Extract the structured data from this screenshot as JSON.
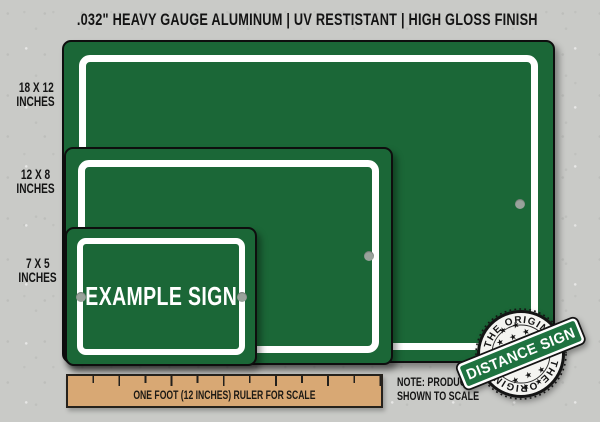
{
  "header": {
    "title": ".032\" HEAVY GAUGE ALUMINUM | UV RESTISTANT | HIGH GLOSS FINISH"
  },
  "size_labels": [
    {
      "size": "18 X 12",
      "unit": "INCHES"
    },
    {
      "size": "12 X 8",
      "unit": "INCHES"
    },
    {
      "size": "7 X 5",
      "unit": "INCHES"
    }
  ],
  "sign": {
    "example_text": "EXAMPLE SIGN"
  },
  "ruler": {
    "label": "ONE FOOT (12 INCHES) RULER FOR SCALE"
  },
  "note": {
    "line1": "NOTE: PRODUCT",
    "line2": "SHOWN TO SCALE"
  },
  "badge": {
    "arc_top": "THE ORIGINAL",
    "arc_bottom": "THE ORIGINAL",
    "banner": "DISTANCE SIGN",
    "stars_row1": "★ ★",
    "stars_row2": "★ ★ ★",
    "stars_row3": "★ ★ ★",
    "stars_row4": "★ ★"
  },
  "colors": {
    "sign_green": "#1b6737",
    "badge_banner_green": "#1e7240",
    "ruler_tan": "#d8a874",
    "background_gray": "#c9cac7",
    "hole_gray": "#99a29b",
    "border_white": "#ffffff",
    "text_black": "#161616"
  }
}
